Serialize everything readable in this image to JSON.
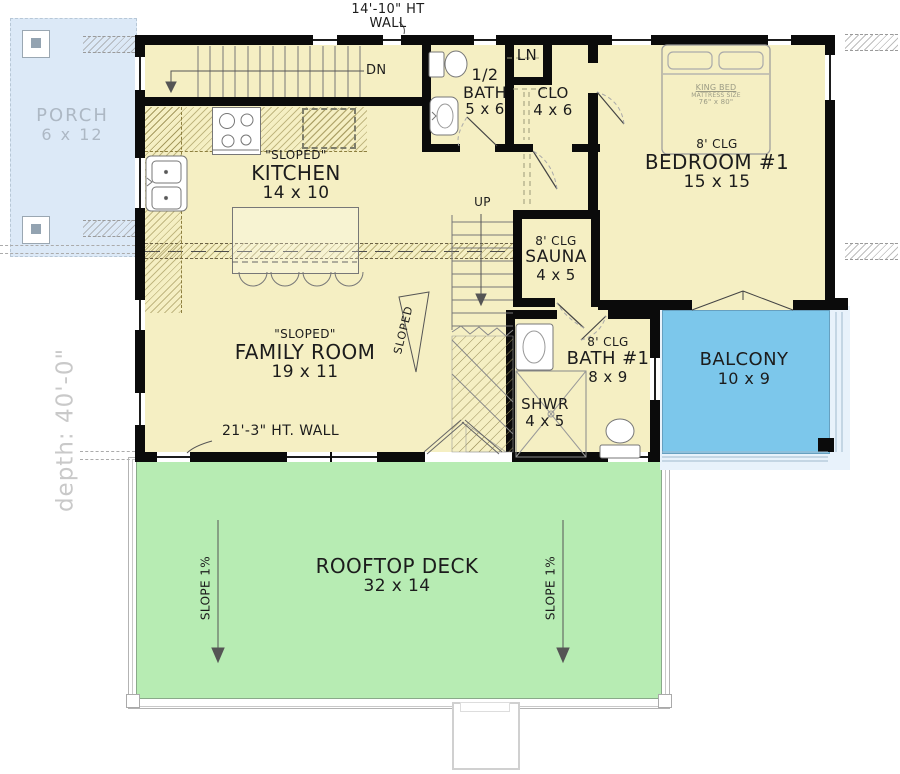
{
  "colors": {
    "floor": "#F5EFC3",
    "wall": "#0B0B0B",
    "deck": "#B7ECB3",
    "balcony": "#7CC7EB",
    "porch": "#DCE9F7",
    "surround": "#E8F2FB",
    "porch_text": "#ADB8C4",
    "depth_text": "#C9C9C9",
    "ink": "#1C1C1C"
  },
  "annotations": {
    "top_wall": {
      "line1": "14'-10\" HT",
      "line2": "WALL"
    },
    "family_wall": "21'-3\" HT. WALL",
    "depth": "depth: 40'-0\"",
    "up": "UP",
    "dn": "DN",
    "slope_indicator": "SLOPED"
  },
  "rooms": {
    "porch": {
      "name": "PORCH",
      "size": "6 x 12"
    },
    "kitchen": {
      "note": "\"SLOPED\"",
      "name": "KITCHEN",
      "size": "14 x 10"
    },
    "half_bath": {
      "line1": "1/2",
      "line2": "BATH",
      "size": "5 x 6"
    },
    "linen": {
      "name": "LN"
    },
    "closet": {
      "name": "CLO",
      "size": "4 x 6"
    },
    "bedroom1": {
      "ceiling": "8' CLG",
      "name": "BEDROOM #1",
      "size": "15 x 15"
    },
    "sauna": {
      "ceiling": "8' CLG",
      "name": "SAUNA",
      "size": "4 x 5"
    },
    "family_room": {
      "note": "\"SLOPED\"",
      "name": "FAMILY ROOM",
      "size": "19 x 11"
    },
    "bath1": {
      "ceiling": "8' CLG",
      "name": "BATH #1",
      "size": "8 x 9"
    },
    "shower": {
      "name": "SHWR",
      "size": "4 x 5"
    },
    "balcony": {
      "name": "BALCONY",
      "size": "10 x 9"
    },
    "rooftop_deck": {
      "name": "ROOFTOP DECK",
      "size": "32 x 14",
      "slope_left": "SLOPE 1%",
      "slope_right": "SLOPE 1%"
    }
  },
  "furniture": {
    "king_bed": {
      "line1": "KING BED",
      "line2": "MATTRESS SIZE",
      "line3": "76\" x 80\""
    }
  }
}
